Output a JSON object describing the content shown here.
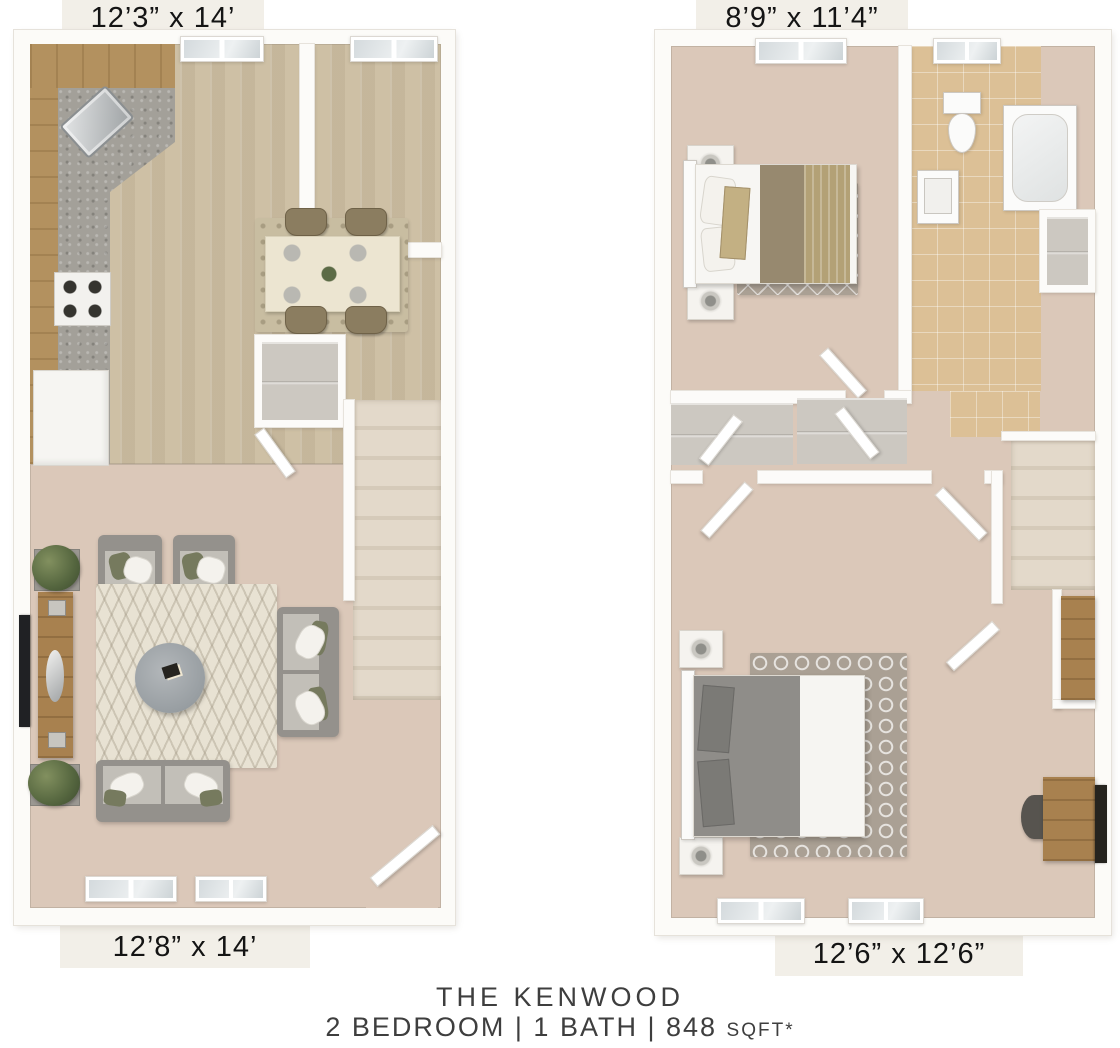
{
  "labels": {
    "first_floor_top": "12’3” x 14’",
    "second_floor_top": "8’9” x 11’4”",
    "first_floor_bottom": "12’8” x 14’",
    "second_floor_bottom": "12’6” x 12’6”"
  },
  "footer": {
    "title": "THE KENWOOD",
    "specs": "2 BEDROOM | 1 BATH | 848",
    "specs_unit": "SQFT*"
  },
  "colors": {
    "wall": "#fcfbf8",
    "carpet": "#dbc8b9",
    "wood-floor": "#cec0a5",
    "tile": "#dcc096",
    "granite": "#a3a099",
    "cabinet": "#b3915f",
    "rug-cream": "#e8e2d3",
    "rug-dining": "#c8bda1",
    "rug-gray": "#aaa094",
    "sofa-gray": "#94918c",
    "cushion": "#c2bfb8",
    "olive": "#767a5e",
    "table-cream": "#ece5d1",
    "bed-brown": "#97896f",
    "bed-tan": "#b3a176",
    "bed-gray": "#8f8d89",
    "stair": "#e3d9ca",
    "wood-furniture": "#a8814f"
  }
}
